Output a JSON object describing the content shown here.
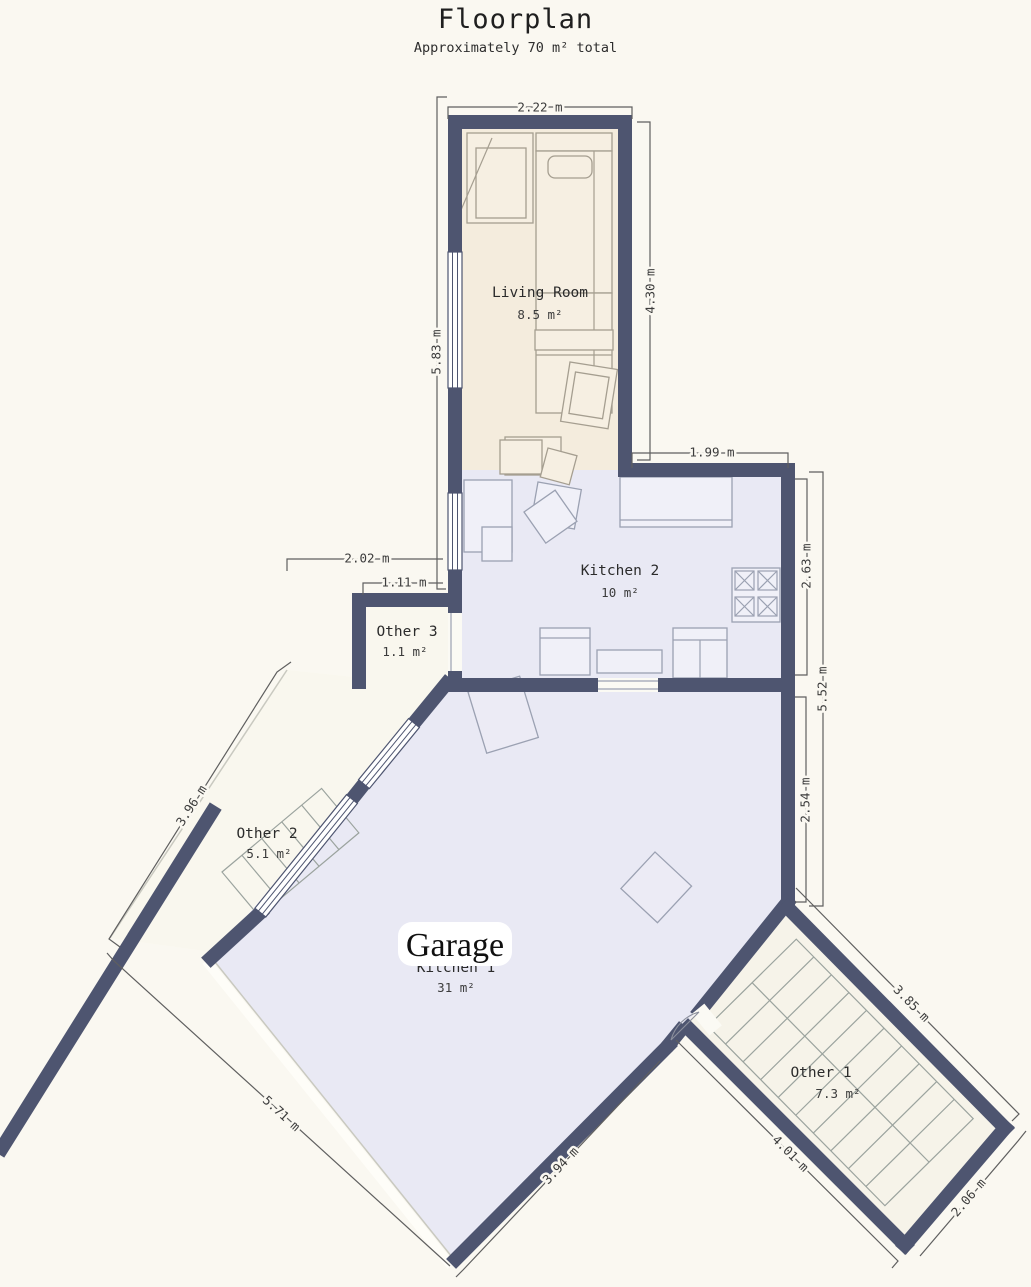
{
  "title": "Floorplan",
  "subtitle": "Approximately 70 m² total",
  "colors": {
    "background": "#faf8f1",
    "wall": "#4e5570",
    "living_floor": "#f4ecdd",
    "kitchen_floor": "#e9e9f4",
    "other_floor": "#f9f7ee",
    "other1_floor": "#f6f3e9"
  },
  "rooms": [
    {
      "id": "living-room",
      "name": "Living Room",
      "area": "8.5 m²"
    },
    {
      "id": "kitchen-2",
      "name": "Kitchen 2",
      "area": "10 m²"
    },
    {
      "id": "other-3",
      "name": "Other 3",
      "area": "1.1 m²"
    },
    {
      "id": "other-2",
      "name": "Other 2",
      "area": "5.1 m²"
    },
    {
      "id": "kitchen-1",
      "name": "Kitchen 1",
      "area": "31 m²"
    },
    {
      "id": "other-1",
      "name": "Other 1",
      "area": "7.3 m²"
    }
  ],
  "overlay_label": "Garage",
  "dimensions": {
    "d222": "2.22 m",
    "d430": "4.30 m",
    "d583": "5.83 m",
    "d199": "1.99 m",
    "d263": "2.63 m",
    "d552": "5.52 m",
    "d254": "2.54 m",
    "d202": "2.02 m",
    "d111": "1.11 m",
    "d396": "3.96 m",
    "d571": "5.71 m",
    "d394": "3.94 m",
    "d401": "4.01 m",
    "d385": "3.85 m",
    "d206": "2.06 m"
  }
}
